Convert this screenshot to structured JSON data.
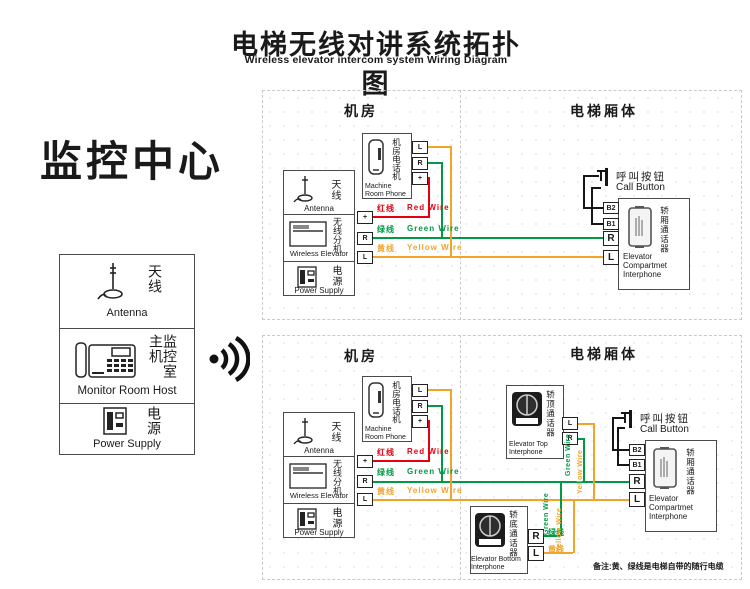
{
  "header": {
    "title_zh": "电梯无线对讲系统拓扑图",
    "title_en": "Wireless elevator intercom system Wiring Diagram"
  },
  "monitor_center": {
    "title": "监控中心",
    "antenna": {
      "zh": "天线",
      "en": "Antenna"
    },
    "host": {
      "zh": "监控室主机",
      "en": "Monitor Room Host"
    },
    "power": {
      "zh": "电源",
      "en": "Power Supply"
    }
  },
  "sections": {
    "machine_room": "机房",
    "elevator_car": "电梯厢体"
  },
  "devices": {
    "machine_room_phone": {
      "zh": "机房电话机",
      "en": "Machine\nRoom Phone"
    },
    "antenna": {
      "zh": "天线",
      "en": "Antenna"
    },
    "wireless_unit": {
      "zh": "无线分机",
      "en": "Wireless Elevator"
    },
    "power_supply": {
      "zh": "电源",
      "en": "Power Supply"
    },
    "call_button": {
      "zh": "呼叫按钮",
      "en": "Call Button"
    },
    "compartment_interphone": {
      "zh": "轿厢通话器",
      "en": "Elevator\nCompartmet\nInterphone"
    },
    "top_interphone": {
      "zh": "轿顶通话器",
      "en": "Elevator Top\nInterphone"
    },
    "bottom_interphone": {
      "zh": "轿底通话器",
      "en": "Elevator Bottom\nInterphone"
    }
  },
  "wires": {
    "red": {
      "zh": "红线",
      "en": "Red Wire",
      "color": "#e60012"
    },
    "green": {
      "zh": "绿线",
      "en": "Green Wire",
      "color": "#009944"
    },
    "yellow": {
      "zh": "黄线",
      "en": "Yellow Wire",
      "color": "#f3a32a"
    }
  },
  "terminals": {
    "l": "L",
    "r": "R",
    "plus": "+",
    "b1": "B1",
    "b2": "B2"
  },
  "note": "备注:黄、绿线是电梯自带的随行电缆"
}
